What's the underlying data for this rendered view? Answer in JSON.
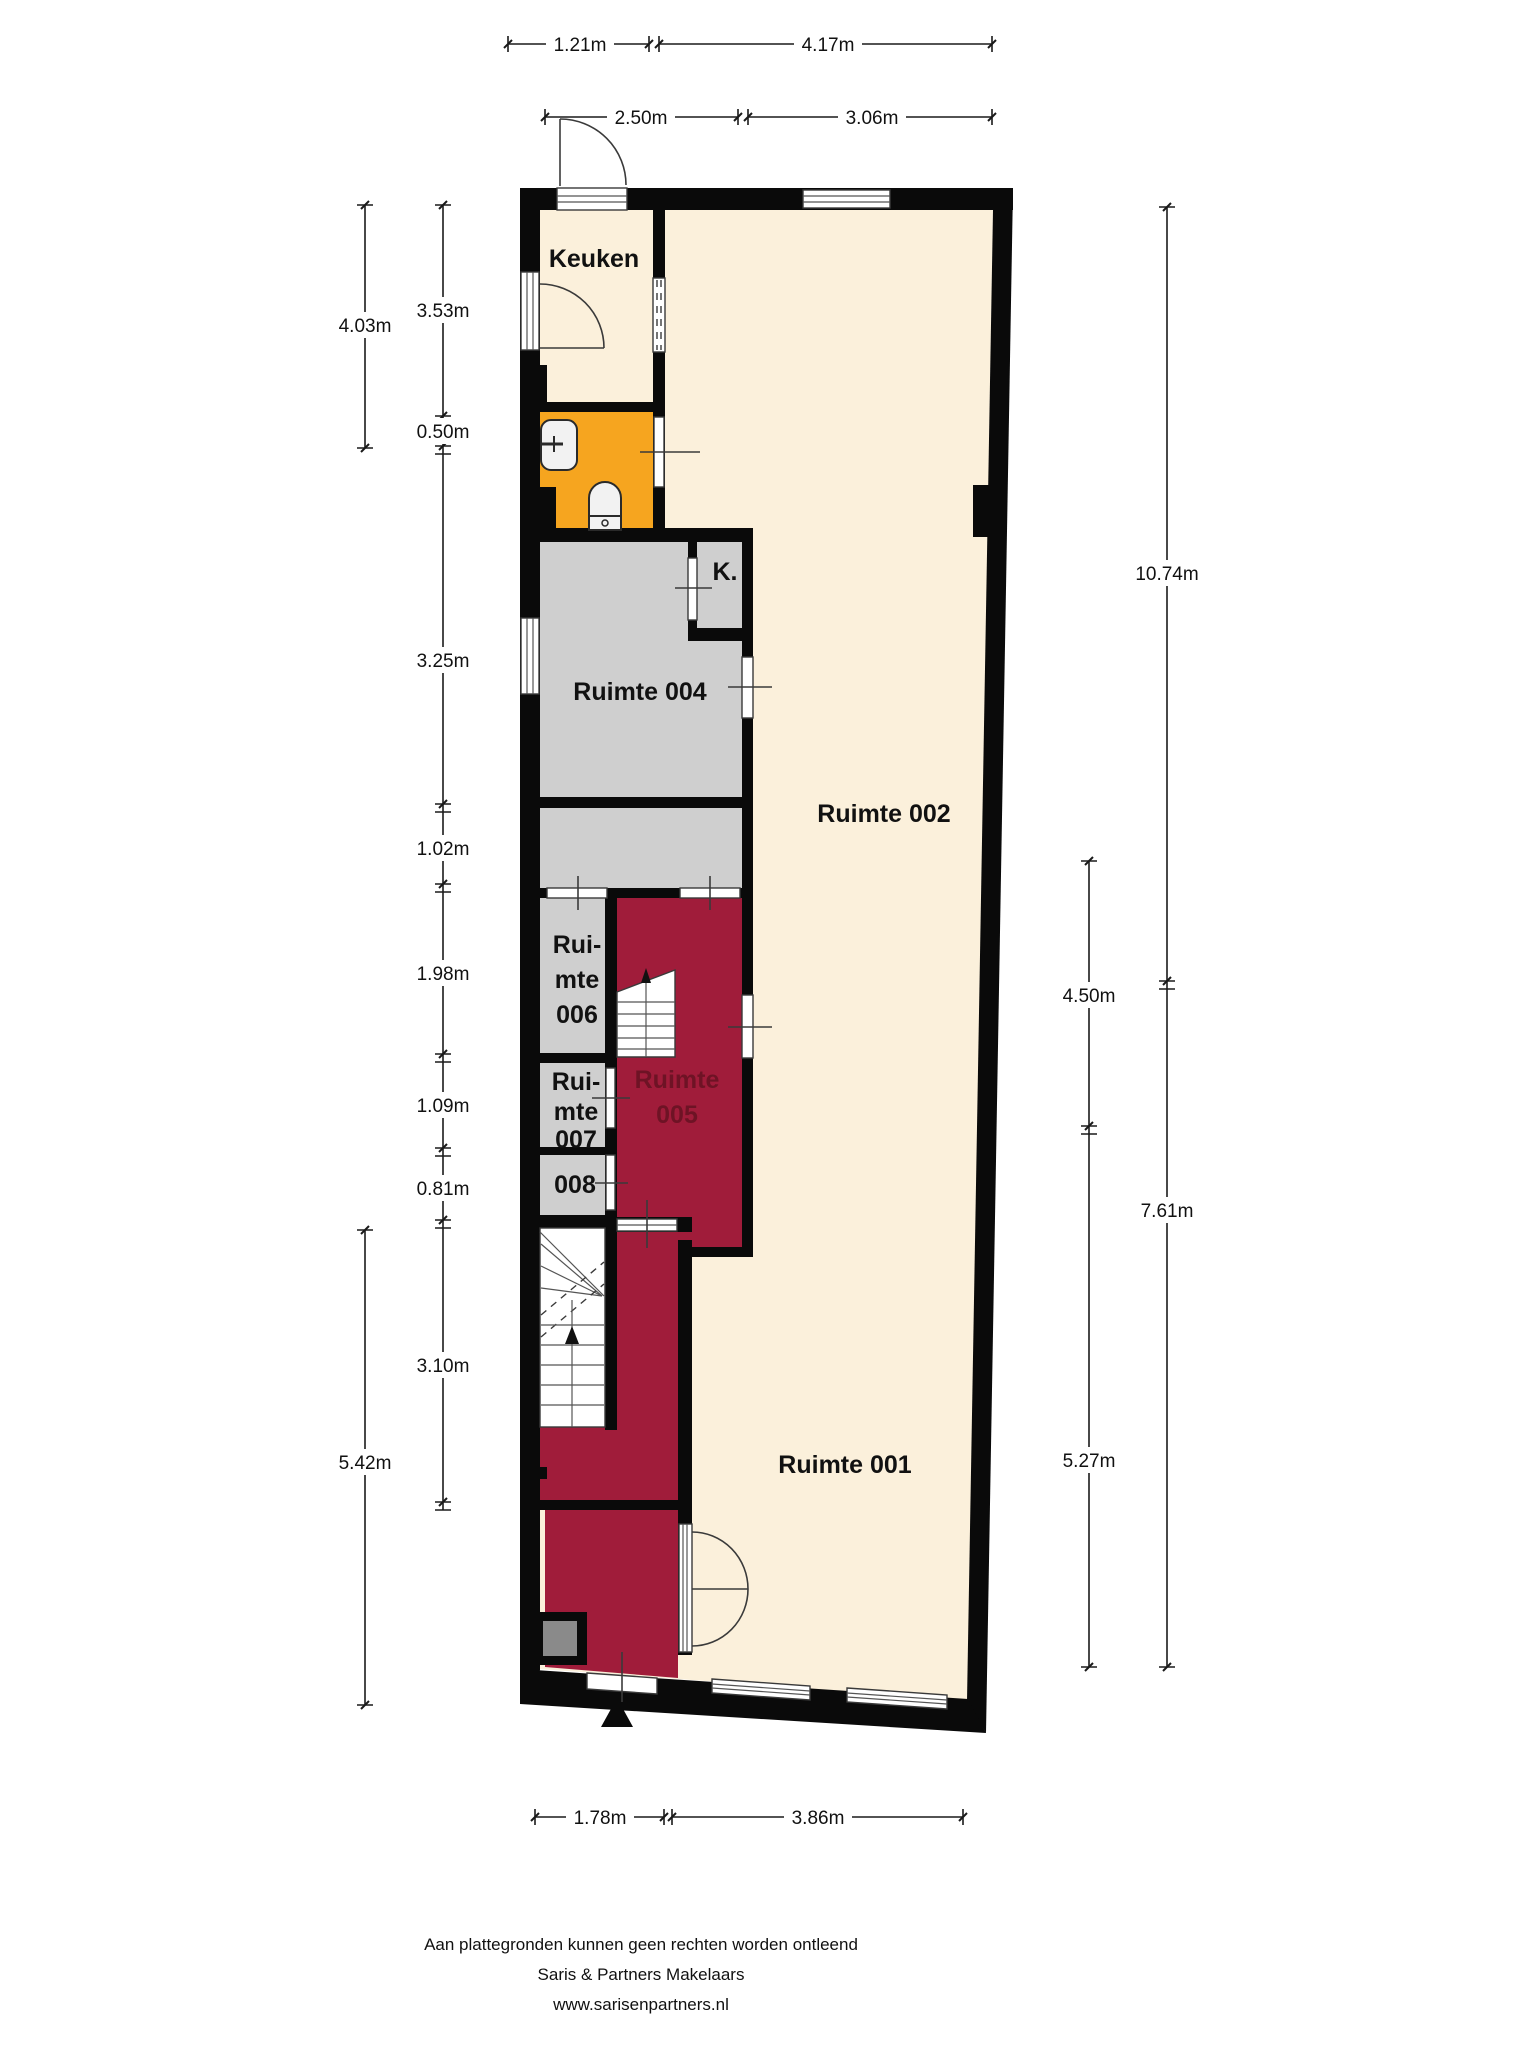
{
  "rooms": {
    "keuken": "Keuken",
    "r001": "Ruimte 001",
    "r002": "Ruimte 002",
    "r004": "Ruimte 004",
    "k_closet": "K.",
    "r005_line1": "Ruimte",
    "r005_line2": "005",
    "r006_line1": "Rui-",
    "r006_line2": "mte",
    "r006_line3": "006",
    "r007_line1": "Rui-",
    "r007_line2": "mte",
    "r007_line3": "007",
    "r008": "008"
  },
  "dimensions": {
    "top_row1": {
      "left": "1.21m",
      "right": "4.17m"
    },
    "top_row2": {
      "left": "2.50m",
      "right": "3.06m"
    },
    "bottom": {
      "left": "1.78m",
      "right": "3.86m"
    },
    "left_outer": {
      "upper": "4.03m",
      "lower": "5.42m"
    },
    "left_inner": {
      "d1": "3.53m",
      "d2": "0.50m",
      "d3": "3.25m",
      "d4": "1.02m",
      "d5": "1.98m",
      "d6": "1.09m",
      "d7": "0.81m",
      "d8": "3.10m"
    },
    "right_outer": {
      "upper": "10.74m",
      "lower": "7.61m"
    },
    "right_inner": {
      "upper": "4.50m",
      "lower": "5.27m"
    }
  },
  "footer": {
    "disclaimer": "Aan plattegronden kunnen geen rechten worden ontleend",
    "company": "Saris & Partners Makelaars",
    "website": "www.sarisenpartners.nl"
  },
  "colors": {
    "room_cream": "#FBF0DB",
    "room_gray": "#CFCFCF",
    "room_red": "#A01C3A",
    "room_orange": "#F6A51F",
    "wall_black": "#0A0A0A",
    "red_room_label": "#6E1325"
  }
}
